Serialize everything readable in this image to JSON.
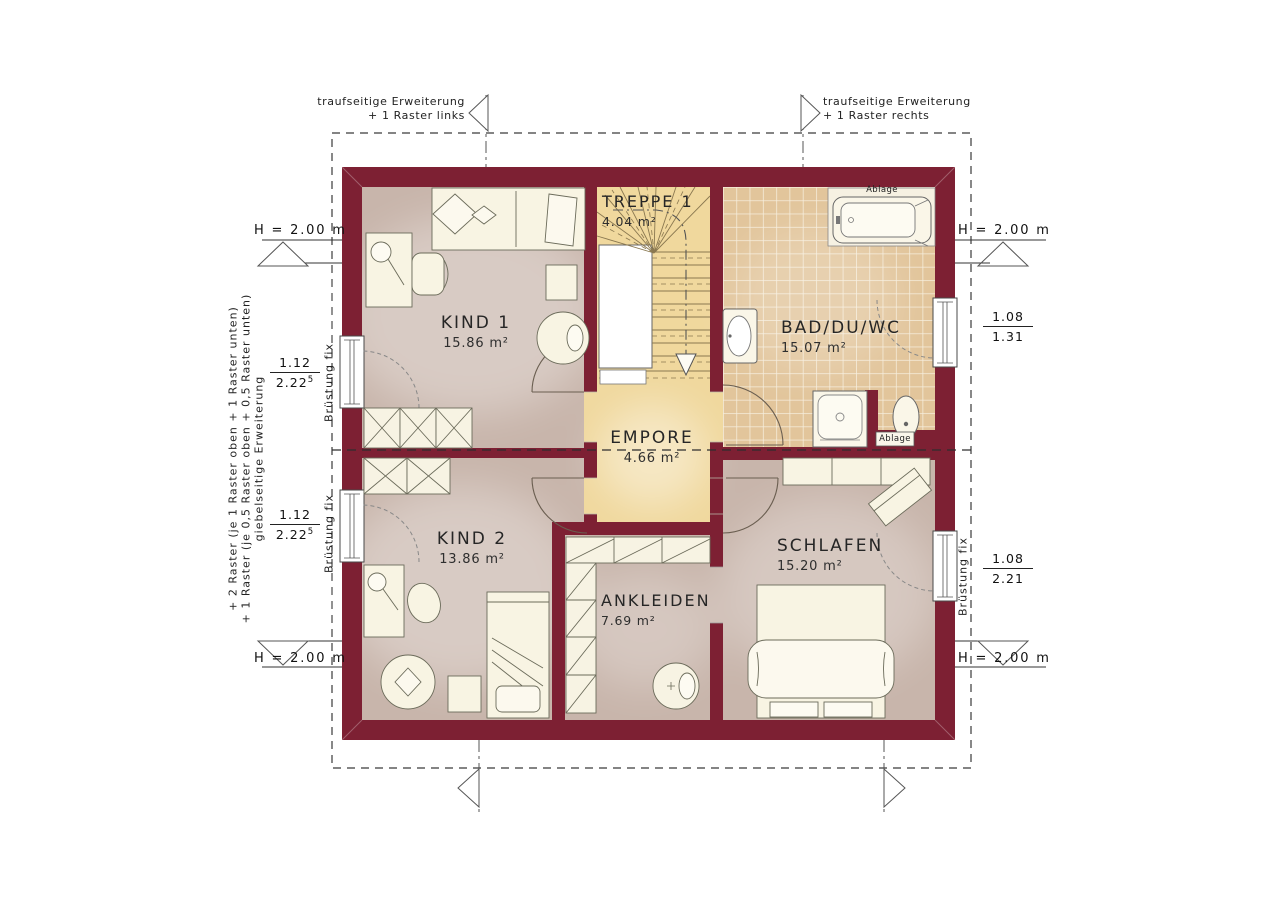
{
  "rooms": {
    "kind1": {
      "name": "KIND 1",
      "area": "15.86 m²"
    },
    "treppe": {
      "name": "TREPPE 1",
      "area": "4.04 m²"
    },
    "bad": {
      "name": "BAD/DU/WC",
      "area": "15.07 m²"
    },
    "empore": {
      "name": "EMPORE",
      "area": "4.66 m²"
    },
    "kind2": {
      "name": "KIND 2",
      "area": "13.86 m²"
    },
    "ankleiden": {
      "name": "ANKLEIDEN",
      "area": "7.69 m²"
    },
    "schlafen": {
      "name": "SCHLAFEN",
      "area": "15.20 m²"
    }
  },
  "annotations": {
    "eaves_left": {
      "line1": "traufseitige Erweiterung",
      "line2": "+ 1 Raster links"
    },
    "eaves_right": {
      "line1": "traufseitige Erweiterung",
      "line2": "+ 1 Raster rechts"
    },
    "gable": {
      "line1": "giebelseitige Erweiterung",
      "line2": "+ 1 Raster (je 0,5 Raster oben + 0,5 Raster unten)",
      "line3": "+ 2 Raster (je 1 Raster oben + 1 Raster unten)"
    },
    "height_label": "H = 2.00 m",
    "parapet_label": "Brüstung fix",
    "shelf_label": "Ablage"
  },
  "dimensions": {
    "left_window_1": {
      "num": "1.12",
      "den": "2.22",
      "den_sup": "5"
    },
    "left_window_2": {
      "num": "1.12",
      "den": "2.22",
      "den_sup": "5"
    },
    "right_window_bath": {
      "num": "1.08",
      "den": "1.31",
      "den_sup": ""
    },
    "right_window_bedroom": {
      "num": "1.08",
      "den": "2.21",
      "den_sup": ""
    }
  },
  "colors": {
    "wall": "#7D2033",
    "floor": "#C8B5AB",
    "gallery_floor": "#F0D89D",
    "tile": "#E2C59B",
    "furniture": "#F8F4E3"
  }
}
